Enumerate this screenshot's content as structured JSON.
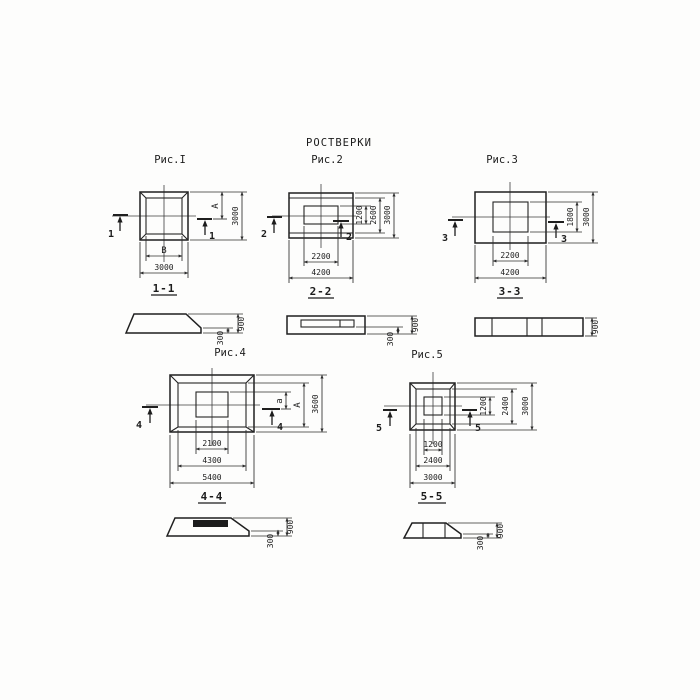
{
  "title": "РОСТВЕРКИ",
  "fig1": {
    "caption": "Рис.I",
    "cut": "1",
    "section_label": "1-1",
    "dim_inner_width": "В",
    "dim_outer_width": "3000",
    "dim_inner_height": "А",
    "dim_outer_height": "3000",
    "section": {
      "height_total": "900",
      "height_edge": "300"
    }
  },
  "fig2": {
    "caption": "Рис.2",
    "cut": "2",
    "section_label": "2-2",
    "dim_inner_width": "2200",
    "dim_outer_width": "4200",
    "dim_inner_height": "1200",
    "dim_mid_height": "2600",
    "dim_outer_height": "3000",
    "section": {
      "height_total": "900",
      "height_edge": "300"
    }
  },
  "fig3": {
    "caption": "Рис.3",
    "cut": "3",
    "section_label": "3-3",
    "dim_inner_width": "2200",
    "dim_outer_width": "4200",
    "dim_inner_height": "1800",
    "dim_outer_height": "3000",
    "section": {
      "height_total": "900"
    }
  },
  "fig4": {
    "caption": "Рис.4",
    "cut": "4",
    "section_label": "4-4",
    "dim_inner_width": "2100",
    "dim_mid_width": "4300",
    "dim_outer_width": "5400",
    "dim_inner_height": "а",
    "dim_mid_height": "А",
    "dim_outer_height": "3600",
    "section": {
      "height_total": "900",
      "height_edge": "300"
    }
  },
  "fig5": {
    "caption": "Рис.5",
    "cut": "5",
    "section_label": "5-5",
    "dim_inner_width": "1200",
    "dim_mid_width": "2400",
    "dim_outer_width": "3000",
    "dim_inner_height": "1200",
    "dim_mid_height": "2400",
    "dim_outer_height": "3000",
    "section": {
      "height_total": "900",
      "height_edge": "300"
    }
  }
}
